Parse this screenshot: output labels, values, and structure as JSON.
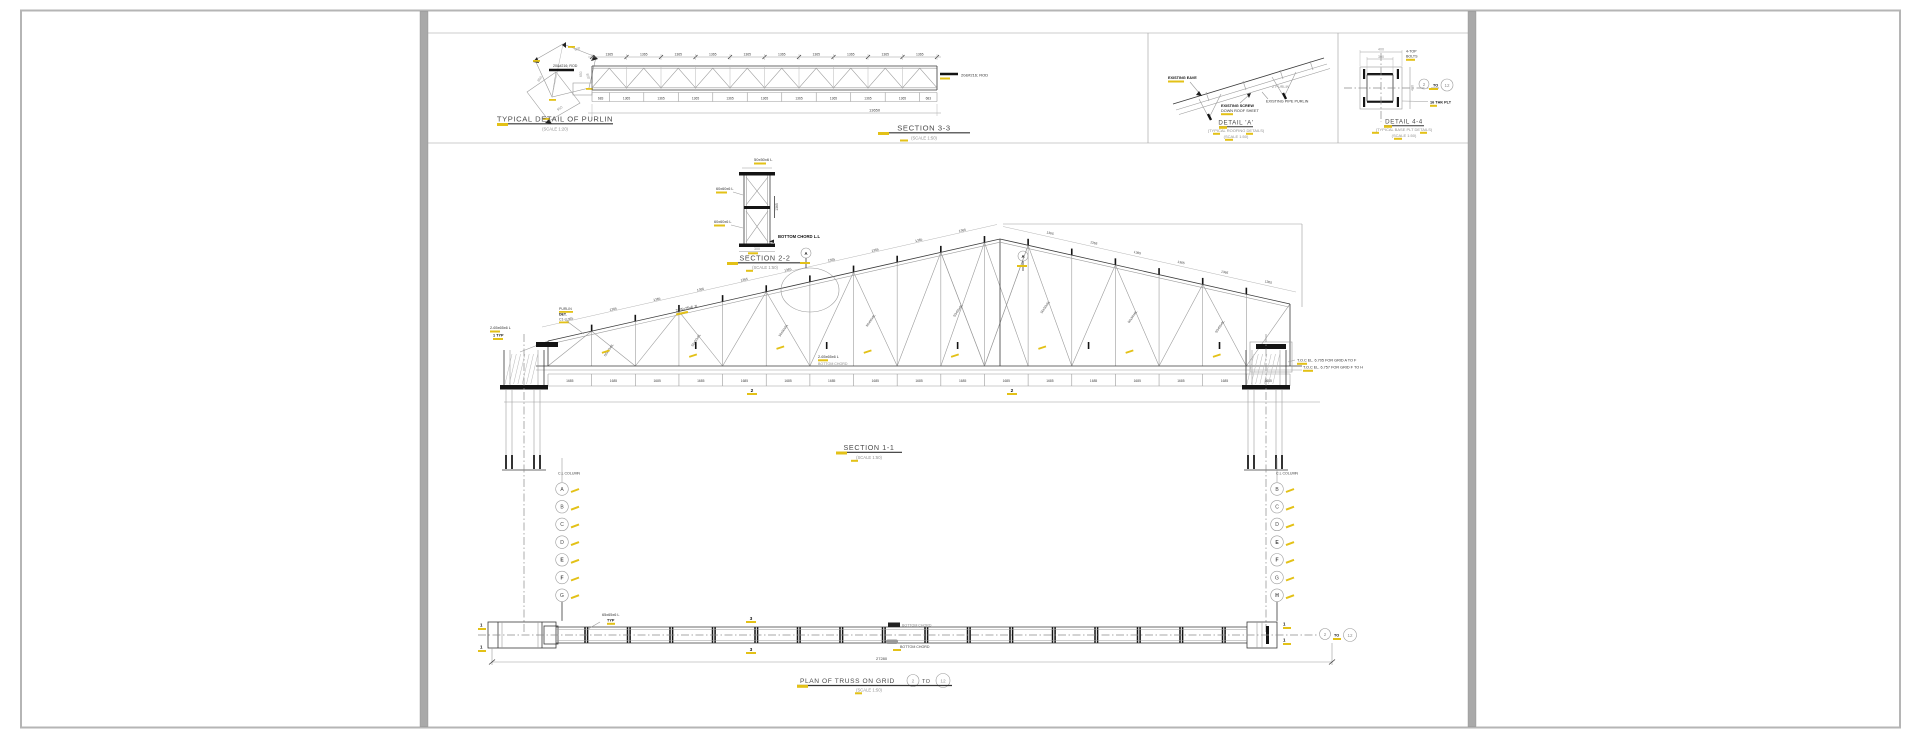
{
  "colors": {
    "highlight": "#e3c117",
    "line_dark": "#333333",
    "line_faint": "#9b9b9b",
    "divider": "#a9a9a9",
    "border": "#b5b5b5"
  },
  "top_band": {
    "purlin_detail": {
      "title": "TYPICAL DETAIL OF PURLIN",
      "scale": "(SCALE 1:20)",
      "rod_label": "20&#216; ROD",
      "dims": [
        "650",
        "800",
        "850",
        "950"
      ]
    },
    "section_3_3": {
      "title": "SECTION 3-3",
      "scale": "(SCALE 1:50)",
      "top_dims": [
        "1365",
        "1365",
        "1365",
        "1365",
        "1365",
        "1365",
        "1365",
        "1365",
        "1365",
        "1365"
      ],
      "bottom_dims": [
        "683",
        "1365",
        "1365",
        "1365",
        "1365",
        "1365",
        "1365",
        "1365",
        "1365",
        "1365",
        "683"
      ],
      "total_dim": "13650",
      "left_dim": "650",
      "rod_label": "20&#216; ROD"
    },
    "detail_a": {
      "title": "DETAIL 'A'",
      "subtitle": "(TYPICAL ROOFING DETAILS)",
      "scale": "(SCALE 1:50)",
      "label_eave": "EXISTING EAVE",
      "label_z": "Z PURLIN",
      "label_screw_1": "EXISTING SCREW",
      "label_screw_2": "DOWN ROOF SHEET",
      "label_pipe": "EXISTING PIPE PURLIN"
    },
    "detail_4_4": {
      "title": "DETAIL 4-4",
      "subtitle": "(TYPICAL BASE PLT DETAILS)",
      "scale": "(SCALE 1:50)",
      "dim_outer": "400",
      "dim_inner": "300",
      "bolt_note_1": "4-TOP",
      "bolt_note_2": "BOLTS",
      "plate_note": "16 THK PLT",
      "grid_from": "2",
      "grid_word": "TO",
      "grid_to": "12"
    }
  },
  "section_2_2": {
    "title": "SECTION 2-2",
    "scale": "(SCALE 1:50)",
    "label_top": "50x50x6 L",
    "label_left_1": "60x60x6 L",
    "label_left_2": "60x60x6 L",
    "label_chord": "BOTTOM CHORD L.L",
    "dim_width": "300",
    "dim_height": "1365"
  },
  "section_1_1": {
    "title": "SECTION 1-1",
    "scale": "(SCALE 1:50)",
    "top_chord_label": "2-75x75x6 JL",
    "chord_label": "2-65x65x6 L",
    "chord_label_2": "BOTTOM CHORD",
    "left_label_1": "2-65x65x6 L",
    "left_label_2": "1 TYP",
    "purlin_note_1": "PURLIN",
    "purlin_note_2": "DET.",
    "purlin_note_3": "C1-L",
    "toc_note_1": "T.O.C EL. 6.705 FOR GRID A TO F",
    "toc_note_2": "T.O.C EL. 6.757 FOR GRID F TO H",
    "diag_label": "50x50x6L",
    "top_dim": "1365",
    "bay_dim": "1685",
    "detail_flag": "A",
    "cut_flag": "2",
    "cl_note": "C.L COLUMN",
    "left_grid_letters": [
      "A",
      "B",
      "C",
      "D",
      "E",
      "F",
      "G"
    ],
    "left_bold": [
      "E",
      "F"
    ],
    "right_grid_letters": [
      "B",
      "C",
      "D",
      "E",
      "F",
      "G",
      "H"
    ],
    "right_bold": [
      "E",
      "F",
      "H"
    ]
  },
  "plan": {
    "title": "PLAN OF TRUSS ON GRID",
    "grid_from": "2",
    "grid_word": "TO",
    "grid_to": "12",
    "scale": "(SCALE 1:50)",
    "member_label": "65x65x6 L",
    "typ_note": "TYP",
    "cut_flag": "3",
    "end_flag": "1",
    "chord_note_top": "BOTTOM CHORD",
    "chord_note_bottom": "BOTTOM CHORD",
    "total_dim": "27280"
  }
}
